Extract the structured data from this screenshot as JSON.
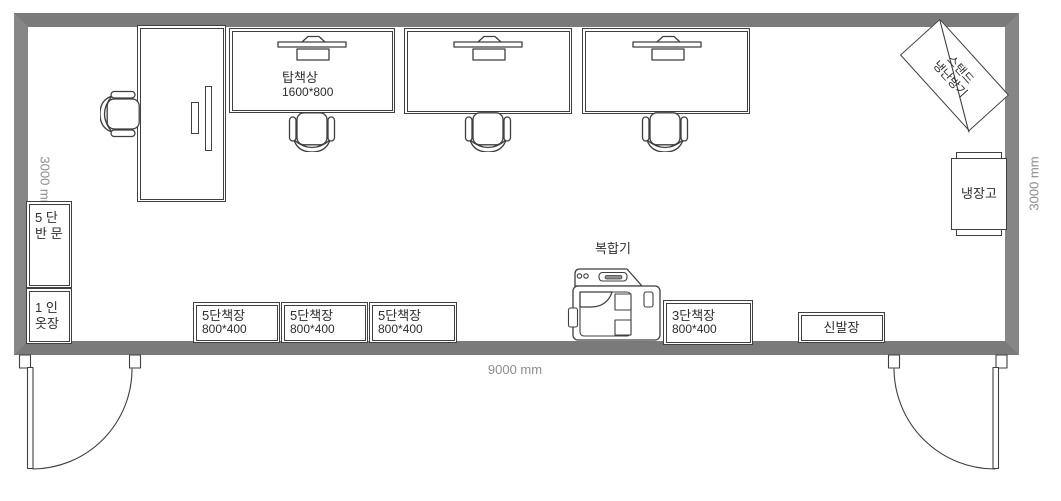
{
  "plan": {
    "title": "office floor plan",
    "dimensions": {
      "bottom": "9000 mm",
      "left": "3000 mm",
      "right": "3000 mm"
    },
    "labels": {
      "desk": {
        "name": "탑책상",
        "size": "1600*800"
      },
      "cabinet_half_door": {
        "l1": "5 단",
        "l2": "반 문"
      },
      "wardrobe": {
        "l1": "1 인",
        "l2": "옷장"
      },
      "bookshelves_5tier": [
        {
          "name": "5단책장",
          "size": "800*400"
        },
        {
          "name": "5단책장",
          "size": "800*400"
        },
        {
          "name": "5단책장",
          "size": "800*400"
        }
      ],
      "bookshelf_3tier": {
        "name": "3단책장",
        "size": "800*400"
      },
      "shoe_cabinet": "신발장",
      "printer": "복합기",
      "fridge": "냉장고",
      "ac_unit": {
        "l1": "스탠드",
        "l2": "냉난방기"
      }
    },
    "colors": {
      "wall": "#7f7f7f",
      "line": "#3f3f3f",
      "dimension_text": "#8c8c8c"
    }
  }
}
